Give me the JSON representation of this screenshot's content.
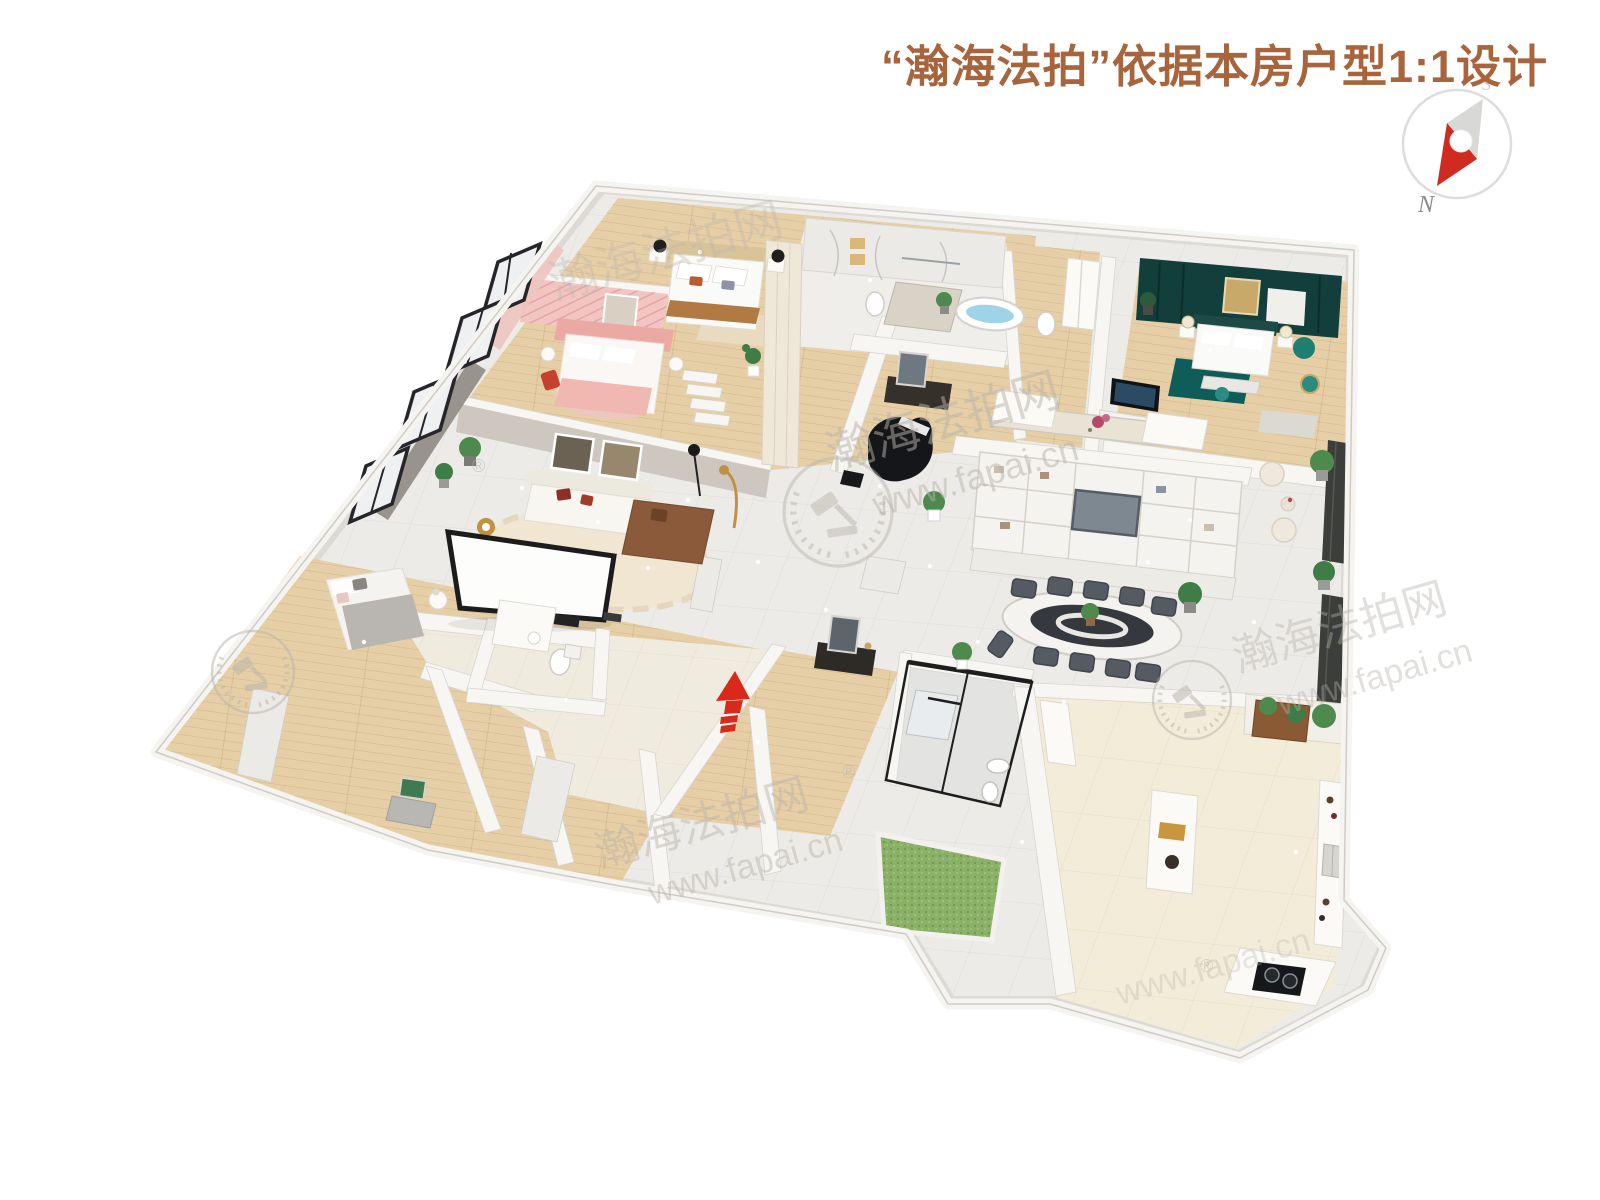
{
  "header": {
    "title": "“瀚海法拍”依据本房户型1:1设计"
  },
  "compass": {
    "north": "N",
    "south": "S"
  },
  "watermark": {
    "brand": "瀚海法拍网",
    "url": "www.fapai.cn",
    "registered": "®"
  },
  "colors": {
    "page_bg": "#ffffff",
    "title_brown": "#a8643c",
    "arrow_red": "#d8291b",
    "compass_red": "#cf2b20",
    "grass_green": "#8bb168",
    "teal_wall": "#123f3b",
    "teal_accent": "#1f7e72",
    "teal_rug": "#0f5d58",
    "pink_wall": "#f2c5c2",
    "wood_floor": "#e6cfa6",
    "tile_floor": "#ecebe8",
    "cream_floor": "#f3ecd9",
    "wall_white": "#f7f6f3",
    "watermark_gray": "#b9b3aa"
  }
}
